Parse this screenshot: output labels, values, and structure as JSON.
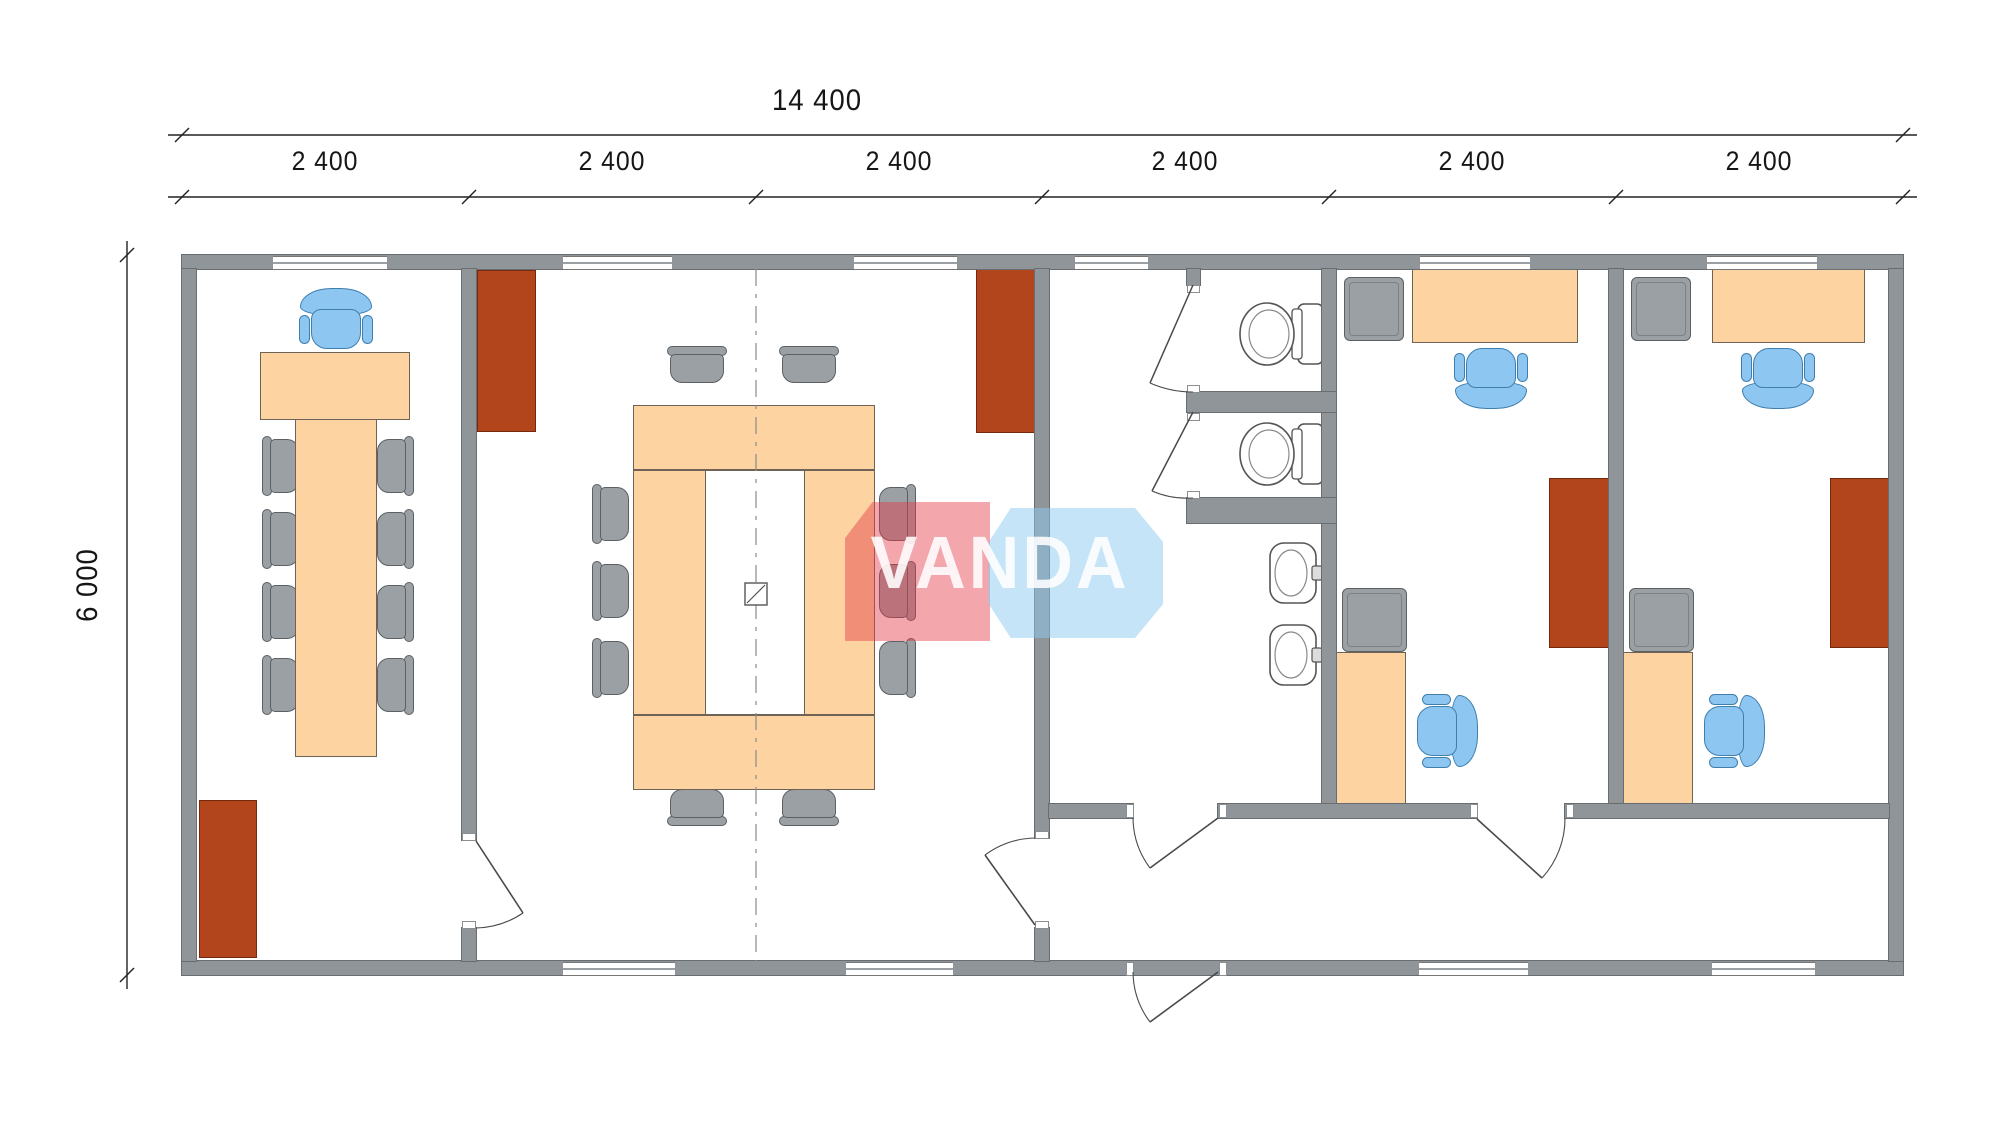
{
  "dimensions": {
    "total_width_label": "14 400",
    "module_labels": [
      "2 400",
      "2 400",
      "2 400",
      "2 400",
      "2 400",
      "2 400"
    ],
    "height_label": "6 000"
  },
  "watermark": {
    "text": "VANDA"
  },
  "colors": {
    "wall": "#90959a",
    "furniture_wood": "#fcd3a1",
    "cabinet_brown": "#b2451b",
    "chair_gray": "#9aa0a4",
    "chair_blue": "#8ec6f2",
    "logo_red": "rgba(228,58,72,0.45)",
    "logo_blue": "rgba(142,201,240,0.5)"
  },
  "plan": {
    "type": "modular-office-floor-plan",
    "overall_width_mm": "14 400",
    "overall_depth_mm": "6 000",
    "module_count": 6,
    "rooms": [
      {
        "name": "meeting-room",
        "furniture": [
          "long meeting table",
          "1 blue executive chair",
          "8 gray side chairs",
          "brown cabinet"
        ]
      },
      {
        "name": "conference-room",
        "furniture": [
          "ring conference table",
          "10 gray side chairs",
          "2 brown cabinets",
          "floor service box"
        ]
      },
      {
        "name": "sanitary-block",
        "furniture": [
          "2 WC stalls with toilets",
          "2 wash basins"
        ]
      },
      {
        "name": "entrance-hall",
        "furniture": [
          "outward opening entrance door",
          "inner lobby door"
        ]
      },
      {
        "name": "office-1",
        "furniture": [
          "desk",
          "blue task chair",
          "side desk",
          "blue side chair",
          "2 gray storage units",
          "brown cabinet"
        ]
      },
      {
        "name": "office-2",
        "furniture": [
          "desk",
          "blue task chair",
          "side desk",
          "blue side chair",
          "2 gray storage units",
          "brown cabinet"
        ]
      }
    ]
  }
}
